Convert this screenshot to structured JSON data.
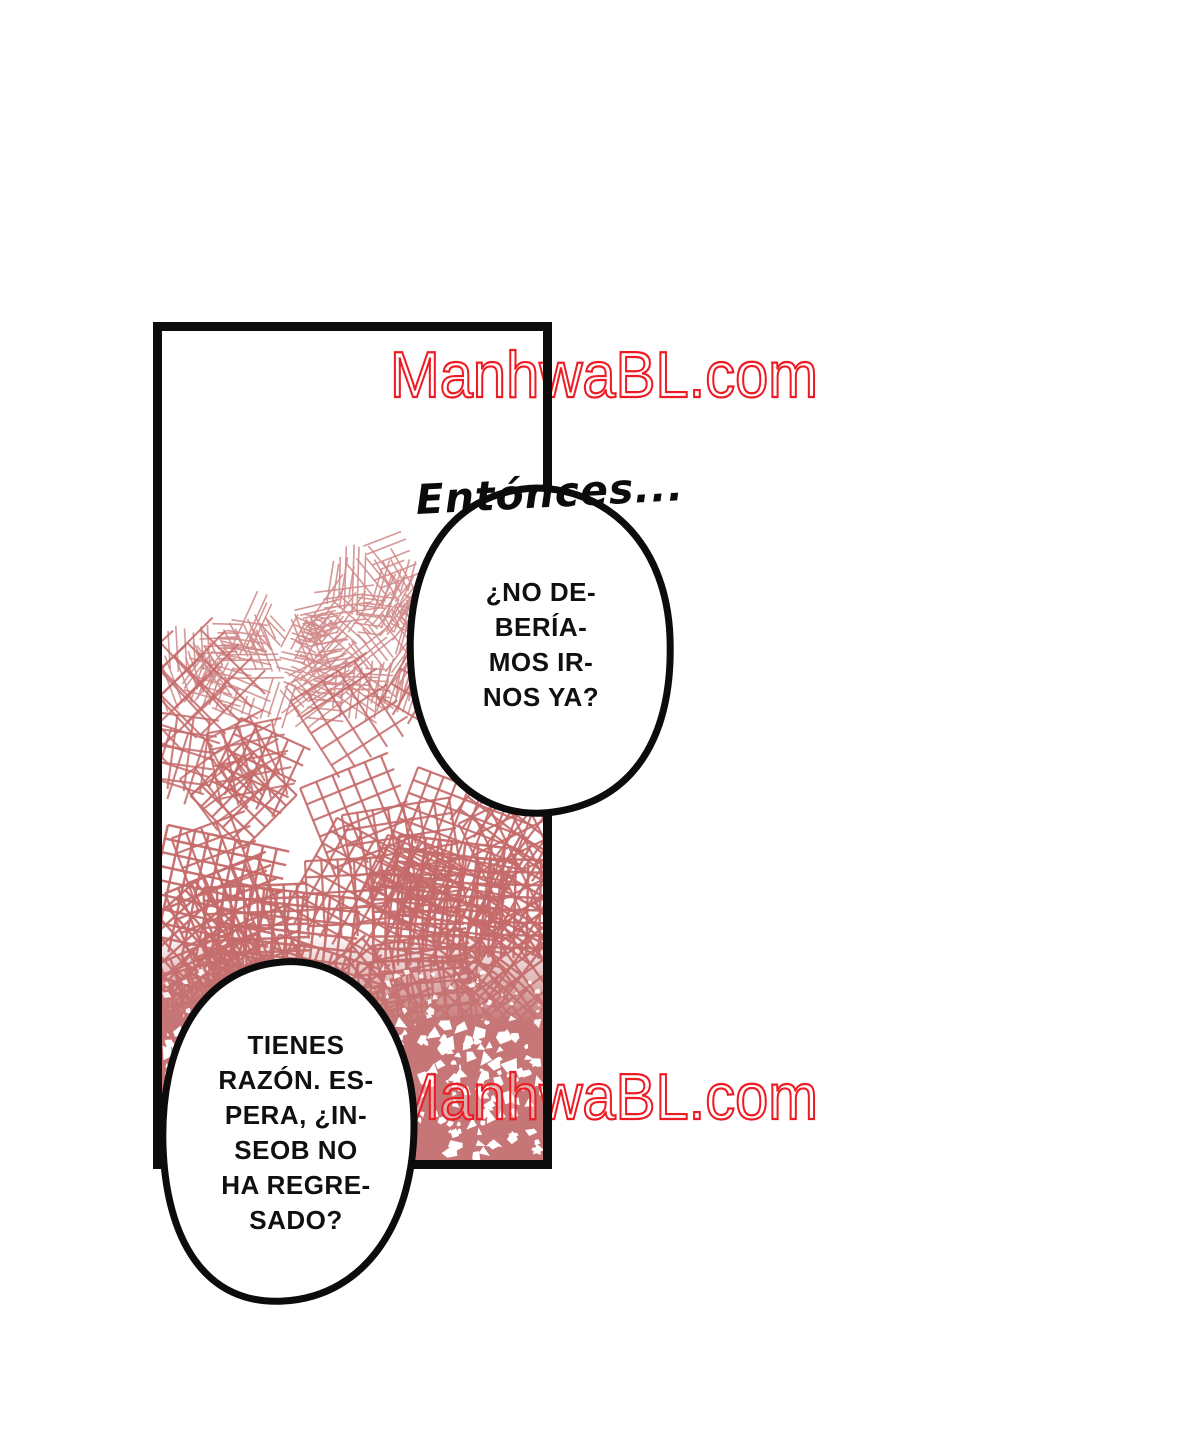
{
  "page": {
    "background": "#ffffff"
  },
  "watermark": {
    "text": "ManhwaBL.com",
    "color": "#ed1c24"
  },
  "bubbles": {
    "top": {
      "lead_in": "Entónces...",
      "lines": [
        "¿NO DE-",
        "BERÍA-",
        "MOS IR-",
        "NOS YA?"
      ]
    },
    "bottom": {
      "lines": [
        "TIENES",
        "RAZÓN. ES-",
        "PERA, ¿IN-",
        "SEOB NO",
        "HA REGRE-",
        "SADO?"
      ]
    }
  },
  "art": {
    "ink_color": "#0c0c0c",
    "texture_line_color": "#c56a6a",
    "texture_dense_color": "#c67676",
    "hatch_light_color": "#d18c8c",
    "speckle_color": "#ffffff"
  }
}
